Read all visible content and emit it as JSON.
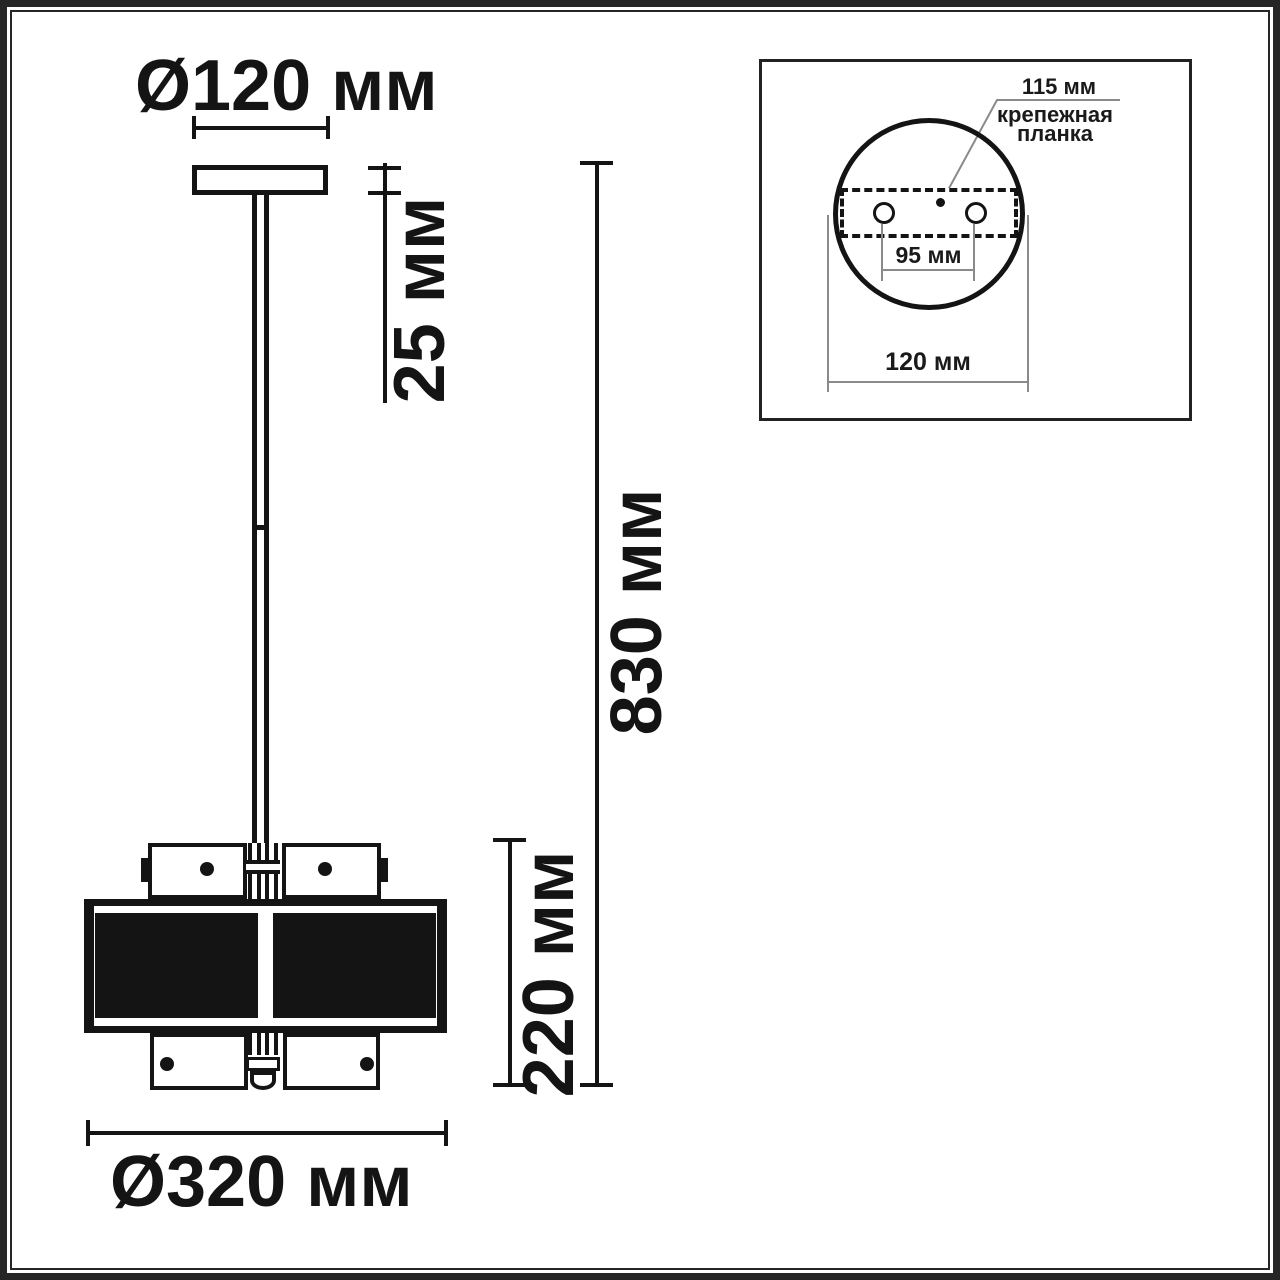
{
  "drawing": {
    "canopy_diameter_label": "Ø120 мм",
    "canopy_height_label": "25 мм",
    "total_height_label": "830 мм",
    "shade_height_label": "220 мм",
    "shade_diameter_label": "Ø320 мм"
  },
  "inset": {
    "plate_length_label": "115 мм",
    "plate_caption_line1": "крепежная",
    "plate_caption_line2": "планка",
    "holes_distance_label": "95 мм",
    "canopy_diameter_label": "120 мм"
  },
  "colors": {
    "ink": "#141414",
    "thin_line": "#8a8a8a",
    "frame": "#262626",
    "background": "#ffffff"
  }
}
